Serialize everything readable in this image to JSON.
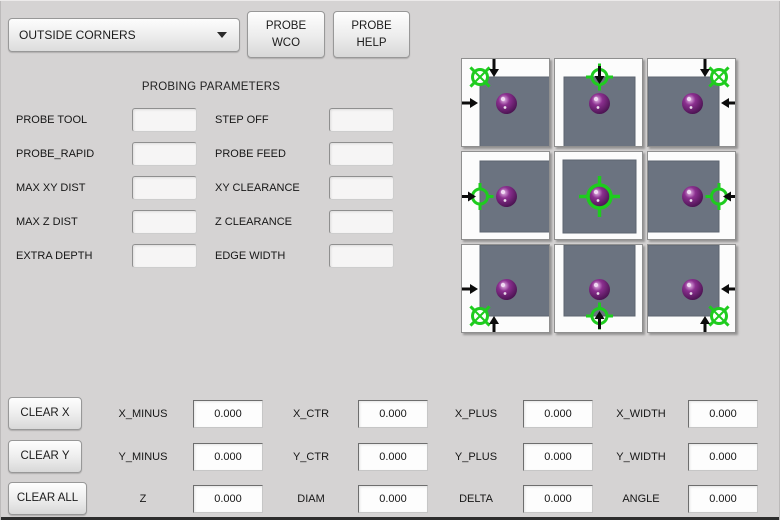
{
  "toolbar": {
    "mode_value": "OUTSIDE CORNERS",
    "probe_wco": {
      "line1": "PROBE",
      "line2": "WCO"
    },
    "probe_help": {
      "line1": "PROBE",
      "line2": "HELP"
    }
  },
  "parameters": {
    "title": "PROBING PARAMETERS",
    "rows": [
      {
        "left": {
          "label": "PROBE TOOL",
          "value": ""
        },
        "right": {
          "label": "STEP OFF",
          "value": ""
        }
      },
      {
        "left": {
          "label": "PROBE_RAPID",
          "value": ""
        },
        "right": {
          "label": "PROBE FEED",
          "value": ""
        }
      },
      {
        "left": {
          "label": "MAX XY DIST",
          "value": ""
        },
        "right": {
          "label": "XY CLEARANCE",
          "value": ""
        }
      },
      {
        "left": {
          "label": "MAX Z DIST",
          "value": ""
        },
        "right": {
          "label": "Z CLEARANCE",
          "value": ""
        }
      },
      {
        "left": {
          "label": "EXTRA DEPTH",
          "value": ""
        },
        "right": {
          "label": "EDGE WIDTH",
          "value": ""
        }
      }
    ]
  },
  "probe_grid": {
    "colors": {
      "tile_bg": "#fcfcfc",
      "square": "#6b7380",
      "square_edge": "#5d6470",
      "crosshair_green": "#1ecc1e",
      "arrow_black": "#0c0c0c",
      "sphere_main": "#8b2f8f",
      "sphere_dark": "#43104a",
      "sphere_highlight": "#e6b9e8"
    },
    "icon_names": [
      "crosshair-target-icon",
      "probe-ball-icon",
      "arrow-up-icon",
      "arrow-down-icon",
      "arrow-left-icon",
      "arrow-right-icon"
    ],
    "tiles": [
      {
        "id": "top-left",
        "square": [
          18,
          18,
          71,
          71
        ],
        "target": {
          "type": "corner",
          "x": 18,
          "y": 18
        },
        "arrows": [
          {
            "dir": "down",
            "pos": 32,
            "tip": 18
          },
          {
            "dir": "right",
            "pos": 44,
            "tip": 16
          }
        ]
      },
      {
        "id": "top-center",
        "square": [
          9,
          18,
          71,
          71
        ],
        "target": {
          "type": "edge",
          "x": 44.5,
          "y": 18
        },
        "arrows": [
          {
            "dir": "down",
            "pos": 44.5,
            "tip": 25
          }
        ]
      },
      {
        "id": "top-right",
        "square": [
          0,
          18,
          71,
          71
        ],
        "target": {
          "type": "corner",
          "x": 71,
          "y": 18
        },
        "arrows": [
          {
            "dir": "down",
            "pos": 57,
            "tip": 18
          },
          {
            "dir": "left",
            "pos": 44,
            "tip": 73
          }
        ]
      },
      {
        "id": "middle-left",
        "square": [
          18,
          9,
          71,
          71
        ],
        "target": {
          "type": "edge",
          "x": 18,
          "y": 44.5
        },
        "arrows": [
          {
            "dir": "right",
            "pos": 44.5,
            "tip": 14
          }
        ]
      },
      {
        "id": "center",
        "square": [
          8,
          8,
          73,
          73
        ],
        "target": {
          "type": "center",
          "x": 44.5,
          "y": 44.5
        },
        "arrows": []
      },
      {
        "id": "middle-right",
        "square": [
          0,
          9,
          71,
          71
        ],
        "target": {
          "type": "edge",
          "x": 71,
          "y": 44.5
        },
        "arrows": [
          {
            "dir": "left",
            "pos": 44.5,
            "tip": 75
          }
        ]
      },
      {
        "id": "bottom-left",
        "square": [
          18,
          0,
          71,
          71
        ],
        "target": {
          "type": "corner",
          "x": 18,
          "y": 71
        },
        "arrows": [
          {
            "dir": "right",
            "pos": 44,
            "tip": 16
          },
          {
            "dir": "up",
            "pos": 32,
            "tip": 71
          }
        ]
      },
      {
        "id": "bottom-center",
        "square": [
          9,
          0,
          71,
          71
        ],
        "target": {
          "type": "edge",
          "x": 44.5,
          "y": 71
        },
        "arrows": [
          {
            "dir": "up",
            "pos": 44.5,
            "tip": 66
          }
        ]
      },
      {
        "id": "bottom-right",
        "square": [
          0,
          0,
          71,
          71
        ],
        "target": {
          "type": "corner",
          "x": 71,
          "y": 71
        },
        "arrows": [
          {
            "dir": "left",
            "pos": 44,
            "tip": 73
          },
          {
            "dir": "up",
            "pos": 57,
            "tip": 71
          }
        ]
      }
    ]
  },
  "results": {
    "clear_buttons": [
      {
        "label": "CLEAR X"
      },
      {
        "label": "CLEAR Y"
      },
      {
        "label": "CLEAR ALL"
      }
    ],
    "rows": [
      {
        "cells": [
          {
            "label": "X_MINUS",
            "value": "0.000"
          },
          {
            "label": "X_CTR",
            "value": "0.000"
          },
          {
            "label": "X_PLUS",
            "value": "0.000"
          },
          {
            "label": "X_WIDTH",
            "value": "0.000"
          }
        ]
      },
      {
        "cells": [
          {
            "label": "Y_MINUS",
            "value": "0.000"
          },
          {
            "label": "Y_CTR",
            "value": "0.000"
          },
          {
            "label": "Y_PLUS",
            "value": "0.000"
          },
          {
            "label": "Y_WIDTH",
            "value": "0.000"
          }
        ]
      },
      {
        "cells": [
          {
            "label": "Z",
            "value": "0.000"
          },
          {
            "label": "DIAM",
            "value": "0.000"
          },
          {
            "label": "DELTA",
            "value": "0.000"
          },
          {
            "label": "ANGLE",
            "value": "0.000"
          }
        ]
      }
    ]
  }
}
